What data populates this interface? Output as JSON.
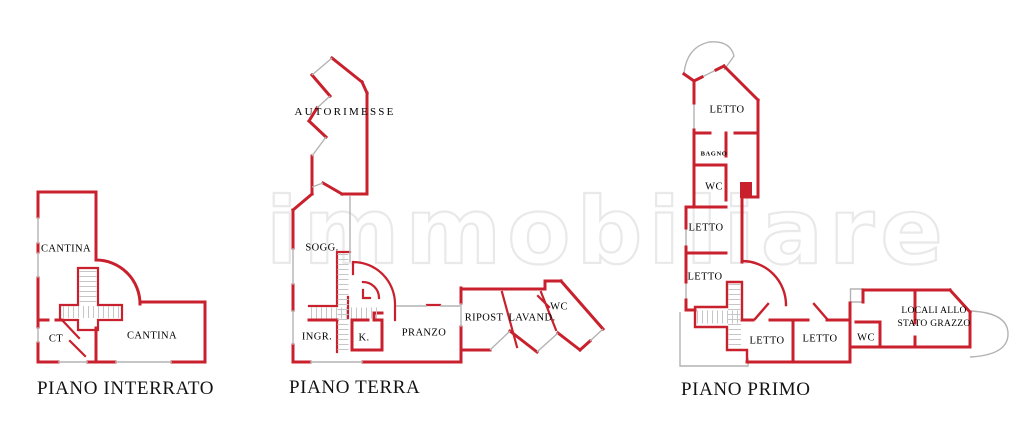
{
  "watermark": {
    "text": "immobiliare"
  },
  "colors": {
    "wall_red": "#c8202c",
    "line_gray": "#b3b3b3",
    "watermark_gray": "#e9e9e9"
  },
  "plans": {
    "interrato": {
      "title": "PIANO INTERRATO",
      "rooms": {
        "cantina_nord": "CANTINA",
        "ct": "CT",
        "cantina_sud": "CANTINA"
      }
    },
    "terra": {
      "title": "PIANO TERRA",
      "rooms": {
        "autorimesse": "AUTORIMESSE",
        "soggiorno": "SOGG.",
        "ingresso": "INGR.",
        "cucina": "K.",
        "pranzo": "PRANZO",
        "ripostiglio": "RIPOST",
        "lavanderia": "LAVAND.",
        "wc": "WC"
      }
    },
    "primo": {
      "title": "PIANO PRIMO",
      "rooms": {
        "letto_nord": "LETTO",
        "bagno": "BAGNO",
        "wc_nord": "WC",
        "letto_centro_1": "LETTO",
        "letto_centro_2": "LETTO",
        "letto_sud_1": "LETTO",
        "letto_sud_2": "LETTO",
        "wc_sud": "WC",
        "locali_riga1": "LOCALI ALLO",
        "locali_riga2": "STATO GRAZZO"
      }
    }
  }
}
